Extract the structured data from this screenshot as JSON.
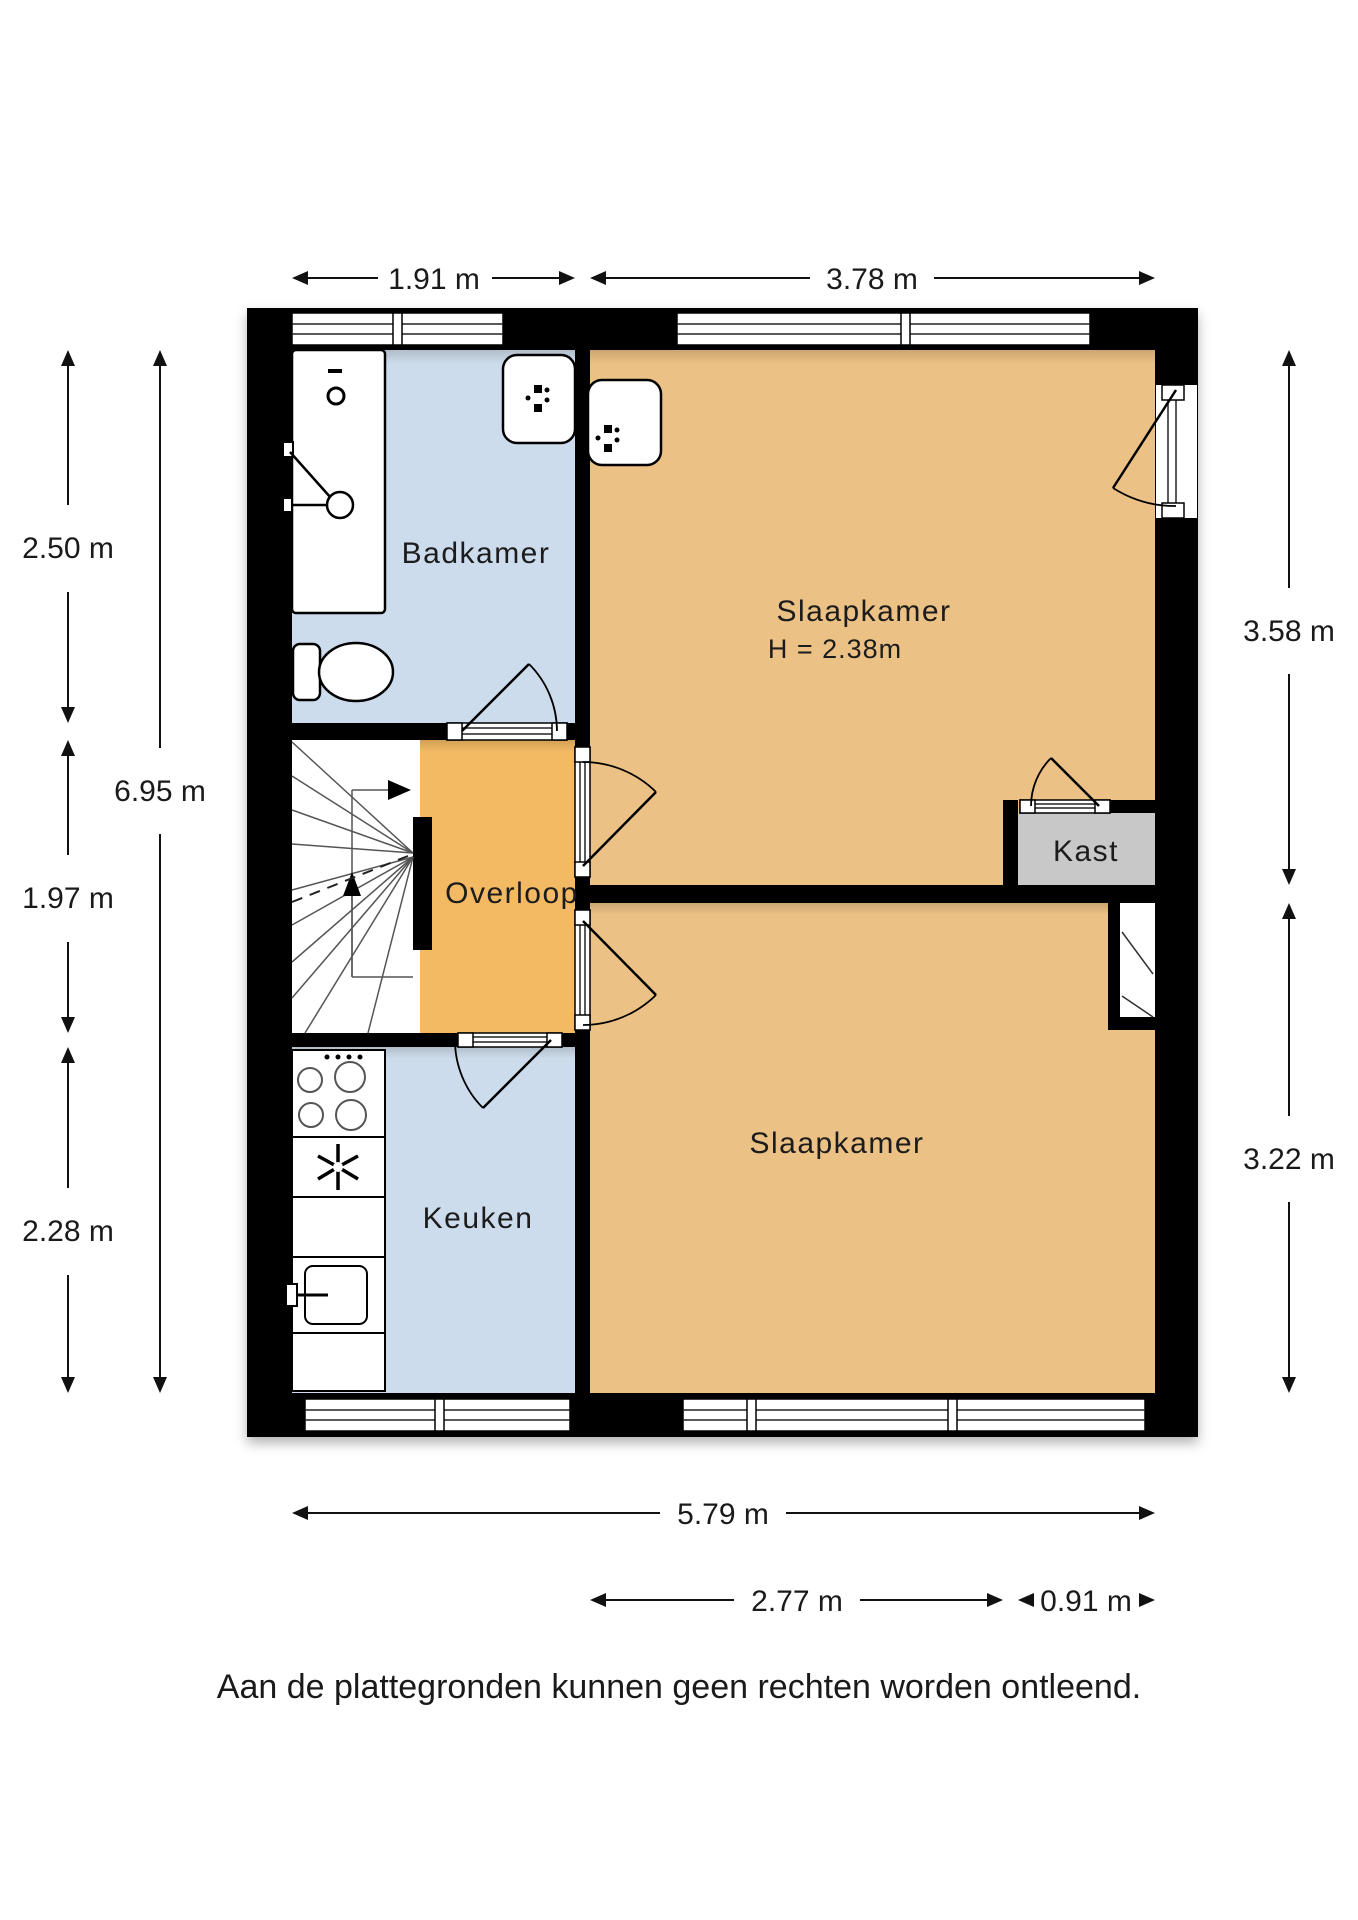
{
  "page": {
    "disclaimer": "Aan de plattegronden kunnen geen rechten worden ontleend."
  },
  "rooms": {
    "badkamer": {
      "label": "Badkamer"
    },
    "slaapkamer1": {
      "label": "Slaapkamer",
      "height_note": "H = 2.38m"
    },
    "overloop": {
      "label": "Overloop"
    },
    "kast": {
      "label": "Kast"
    },
    "keuken": {
      "label": "Keuken"
    },
    "slaapkamer2": {
      "label": "Slaapkamer"
    }
  },
  "dimensions": {
    "top_left": "1.91 m",
    "top_right": "3.78 m",
    "left_upper": "2.50 m",
    "left_middle": "1.97 m",
    "left_total": "6.95 m",
    "left_lower": "2.28 m",
    "right_upper": "3.58 m",
    "right_lower": "3.22 m",
    "bottom_total": "5.79 m",
    "bottom_room": "2.77 m",
    "bottom_kast": "0.91 m"
  },
  "colors": {
    "wall": "#000000",
    "wet_room": "#cddcec",
    "bedroom": "#ecc185",
    "landing": "#f3ba64",
    "closet": "#c8c8c8"
  }
}
